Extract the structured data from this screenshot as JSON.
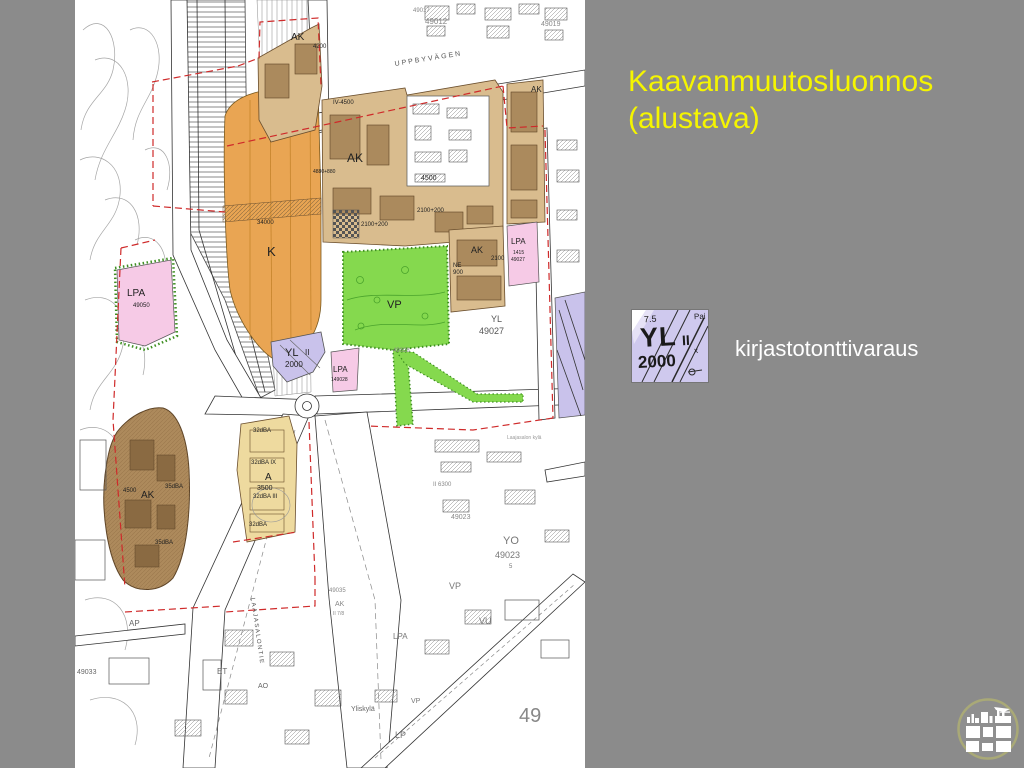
{
  "slide": {
    "background_color": "#8b8b8b",
    "title_line1": "Kaavanmuutosluonnos",
    "title_line2": "(alustava)",
    "title_color": "#f5f500"
  },
  "legend": {
    "label": "kirjastotonttivaraus",
    "tile": {
      "height_number": "7.5",
      "code": "YL",
      "floors": "II",
      "cross": "x",
      "efficiency": "2000",
      "corner": "Pai",
      "background": "#cfc9ee"
    }
  },
  "footer_logo": {
    "icon": "city-buildings-icon",
    "ring_color": "#a9a977"
  },
  "map": {
    "colors": {
      "orange": "#e9a553",
      "tan": "#d9bc8e",
      "brown": "#ab8a5d",
      "dark_tan": "#ad8a5c",
      "light_tan": "#eeda9f",
      "green": "#85d94e",
      "pink": "#f6cae6",
      "lavender": "#c9c2eb",
      "boundary_red": "#cf2a2a",
      "paper": "#ffffff"
    },
    "labels": [
      {
        "text": "49017"
      },
      {
        "text": "AK"
      },
      {
        "text": "4200"
      },
      {
        "text": "49012"
      },
      {
        "text": "49019"
      },
      {
        "text": "UPPBYVÄGEN"
      },
      {
        "text": "IV-4500"
      },
      {
        "text": "AK"
      },
      {
        "text": "4500"
      },
      {
        "text": "4880+880"
      },
      {
        "text": "2100+200"
      },
      {
        "text": "2100+200"
      },
      {
        "text": "AK"
      },
      {
        "text": "K"
      },
      {
        "text": "34000"
      },
      {
        "text": "LPA"
      },
      {
        "text": "49050"
      },
      {
        "text": "VP"
      },
      {
        "text": "AK"
      },
      {
        "text": "2100"
      },
      {
        "text": "NE"
      },
      {
        "text": "900"
      },
      {
        "text": "LPA"
      },
      {
        "text": "1415"
      },
      {
        "text": "49027"
      },
      {
        "text": "YL"
      },
      {
        "text": "49027"
      },
      {
        "text": "YL"
      },
      {
        "text": "II"
      },
      {
        "text": "2000"
      },
      {
        "text": "LPA"
      },
      {
        "text": "149028"
      },
      {
        "text": "49028"
      },
      {
        "text": "AK"
      },
      {
        "text": "4500"
      },
      {
        "text": "35dBA"
      },
      {
        "text": "35dBA"
      },
      {
        "text": "A"
      },
      {
        "text": "3500"
      },
      {
        "text": "32dBA IX"
      },
      {
        "text": "32dBA III"
      },
      {
        "text": "32dBA"
      },
      {
        "text": "32dBA"
      },
      {
        "text": "II 6300"
      },
      {
        "text": "49023"
      },
      {
        "text": "YO"
      },
      {
        "text": "49023"
      },
      {
        "text": "5"
      },
      {
        "text": "VP"
      },
      {
        "text": "49035"
      },
      {
        "text": "AK"
      },
      {
        "text": "II 7/8"
      },
      {
        "text": "VU"
      },
      {
        "text": "LPA"
      },
      {
        "text": "AP"
      },
      {
        "text": "ET"
      },
      {
        "text": "AO"
      },
      {
        "text": "49033"
      },
      {
        "text": "LAAJASALONTIE"
      },
      {
        "text": "Yliskylä"
      },
      {
        "text": "LP"
      },
      {
        "text": "49"
      },
      {
        "text": "VP"
      },
      {
        "text": "Laajasalon kylä"
      }
    ]
  }
}
